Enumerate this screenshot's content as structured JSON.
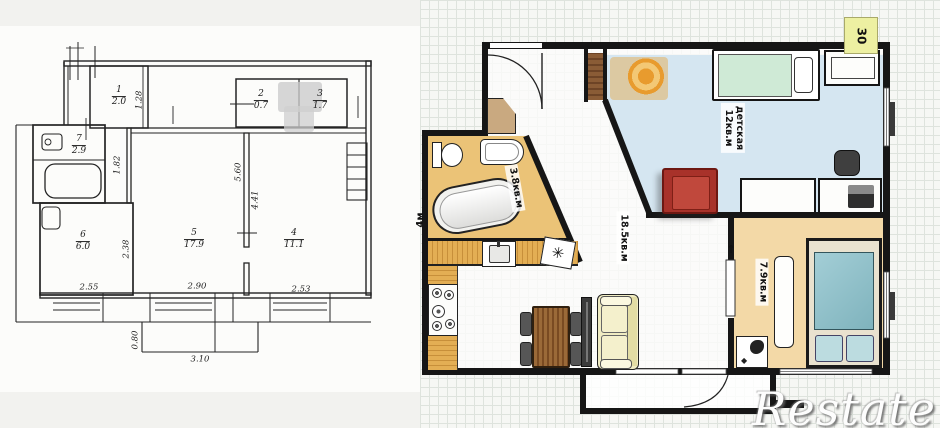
{
  "left_plan": {
    "rooms": [
      {
        "num": "1",
        "area": "2.0"
      },
      {
        "num": "2",
        "area": "0.7"
      },
      {
        "num": "3",
        "area": "1.7"
      },
      {
        "num": "7",
        "area": "2.9"
      },
      {
        "num": "6",
        "area": "6.0"
      },
      {
        "num": "5",
        "area": "17.9"
      },
      {
        "num": "4",
        "area": "11.1"
      }
    ],
    "dims": {
      "room1_height": "1.28",
      "hall_height": "1.82",
      "center_a": "5.60",
      "center_b": "4.41",
      "room6_height": "2.38",
      "room6_width": "2.55",
      "room5_width": "2.90",
      "room4_width": "2.53",
      "balcony_depth": "0.80",
      "balcony_width": "3.10"
    }
  },
  "right_plan": {
    "bathroom_area": "3.8кв.м",
    "living_area": "18.5кв.м",
    "children_name": "детская",
    "children_area": "12кв.м",
    "bedroom_area": "7.9кв.м",
    "wall_tag": "30",
    "side_dim": "4м",
    "watermark": "Restate",
    "icons": {
      "appliance": "✳",
      "door_arrow": "↑"
    },
    "colors": {
      "bath_floor": "#ebc377",
      "kitchen_wood": "#e3ae54",
      "children_floor": "#d5e6f1",
      "bedroom_floor": "#f3d9a7",
      "bed_teal": "#8fc3cc",
      "kids_bed_green": "#cfead6",
      "armchair_red": "#a8322a",
      "sofa_cream": "#f0ecc2",
      "tag_yellow": "#edf0a2"
    }
  }
}
